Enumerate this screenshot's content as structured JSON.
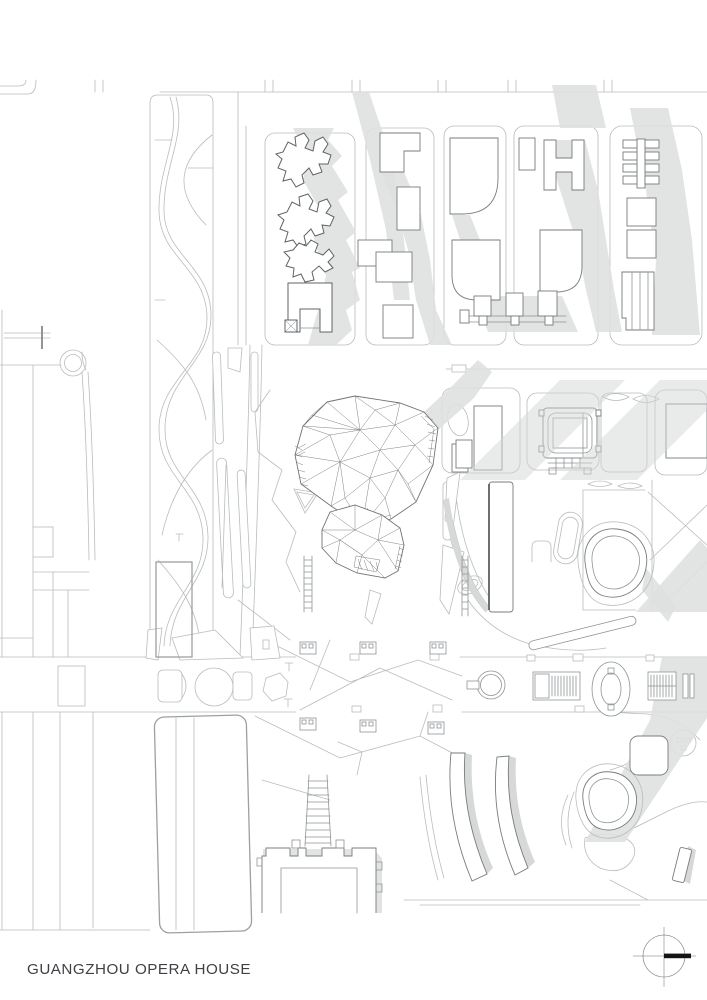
{
  "drawing": {
    "title": "GUANGZHOU OPERA HOUSE"
  },
  "compass": {
    "icon": "north-arrow-compass",
    "needle_side": "right"
  },
  "palette": {
    "road": "#b9bcbd",
    "road2": "#9ba0a2",
    "bld": "#787c7e",
    "bldd": "#5f6365",
    "mesh": "#6f7375",
    "det": "#8f9496",
    "shadow": "#dfe0e0",
    "shadow2": "#d4d5d5",
    "shadow3": "#d7d8d8",
    "text": "#3e4043",
    "needle": "#141414"
  }
}
